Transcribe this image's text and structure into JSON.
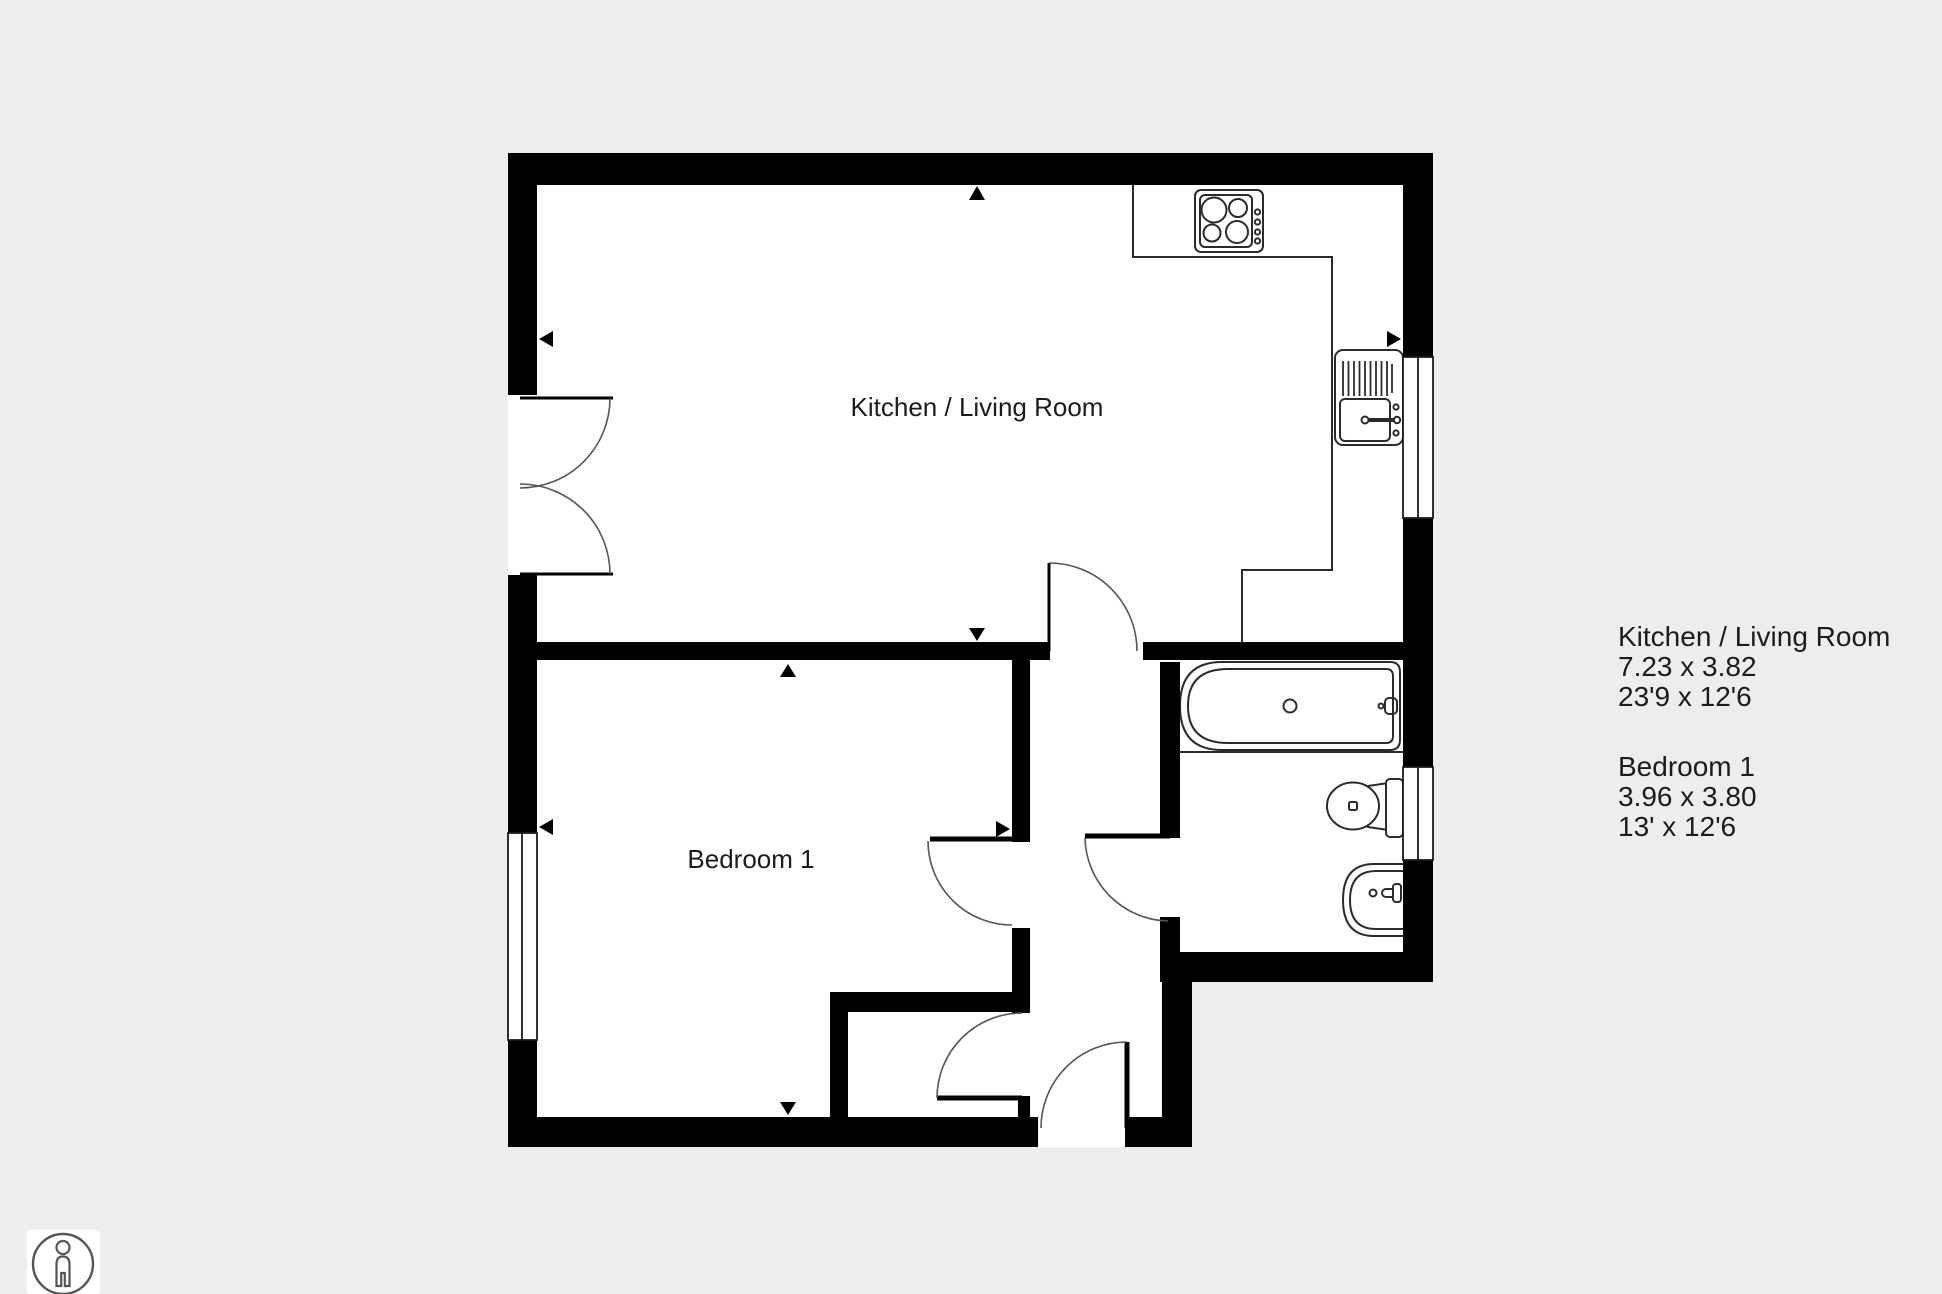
{
  "canvas": {
    "background_color": "#ededed",
    "wall_color": "#000000",
    "floor_color": "#ffffff",
    "line_color": "#333333",
    "text_color": "#1c1c1c"
  },
  "rooms": [
    {
      "id": "kitchen_living_room",
      "label": "Kitchen / Living Room"
    },
    {
      "id": "bedroom_1",
      "label": "Bedroom 1"
    }
  ],
  "legend": {
    "entries": [
      {
        "name": "Kitchen / Living Room",
        "metric": "7.23 x 3.82",
        "imperial": "23'9 x 12'6"
      },
      {
        "name": "Bedroom 1",
        "metric": "3.96 x 3.80",
        "imperial": "13' x 12'6"
      }
    ]
  },
  "fixtures": [
    "hob-icon",
    "sink-drainer-icon",
    "bath-icon",
    "toilet-icon",
    "basin-icon"
  ],
  "markers": [
    "measure-arrow-up-kitchen",
    "measure-arrow-left-kitchen",
    "measure-arrow-right-kitchen",
    "measure-arrow-down-kitchen",
    "measure-arrow-up-bedroom",
    "measure-arrow-left-bedroom",
    "measure-arrow-right-bedroom",
    "measure-arrow-down-bedroom"
  ],
  "icons": {
    "scale_person": "person-in-circle"
  }
}
